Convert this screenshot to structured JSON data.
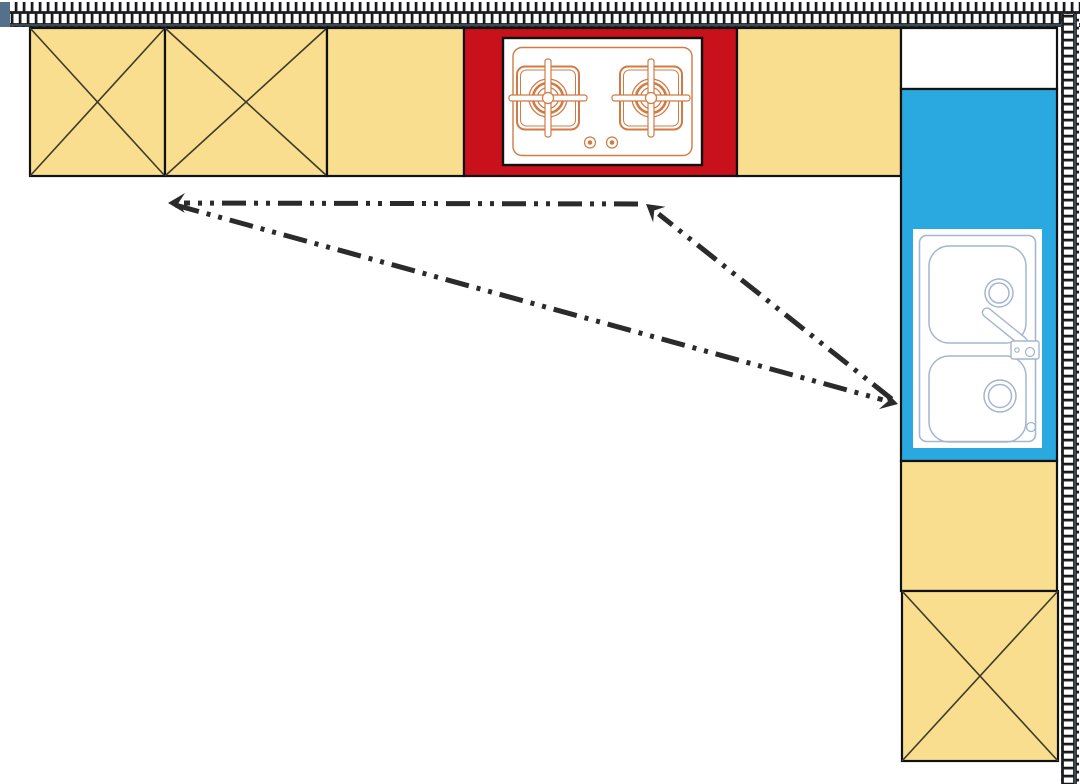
{
  "diagram": {
    "type": "kitchen-floor-plan-with-work-triangle",
    "colors": {
      "cabinet_yellow": "#F8DE8E",
      "stove_red": "#C8111A",
      "sink_blue": "#29A9E0",
      "wall_mortar": "#54718C",
      "brick_fill": "#FFFFFF",
      "brick_outline": "#151515",
      "outline_black": "#111111",
      "cross_line": "#3F3A2A",
      "stove_line_orange": "#D07B45",
      "sink_line_blue": "#A4B6D2",
      "arrow_dark": "#2B2B2B",
      "floor_white": "#FFFFFF"
    },
    "walls": [
      {
        "name": "top-wall",
        "x": 0,
        "y": 2,
        "w": 1080,
        "h": 25,
        "orientation": "horizontal"
      },
      {
        "name": "right-wall",
        "x": 1061,
        "y": 14,
        "w": 18,
        "h": 770,
        "orientation": "vertical"
      }
    ],
    "counter_cells": [
      {
        "name": "base-cabinet-1",
        "x": 30,
        "y": 28,
        "w": 135,
        "h": 148,
        "fill": "yellow",
        "crossed": true
      },
      {
        "name": "base-cabinet-2",
        "x": 165,
        "y": 28,
        "w": 162,
        "h": 148,
        "fill": "yellow",
        "crossed": true
      },
      {
        "name": "base-cabinet-3",
        "x": 327,
        "y": 28,
        "w": 137,
        "h": 148,
        "fill": "yellow",
        "crossed": false
      },
      {
        "name": "cooktop-counter",
        "x": 464,
        "y": 28,
        "w": 273,
        "h": 148,
        "fill": "red",
        "crossed": false
      },
      {
        "name": "base-cabinet-4",
        "x": 737,
        "y": 28,
        "w": 164,
        "h": 148,
        "fill": "yellow",
        "crossed": false
      },
      {
        "name": "corner-counter",
        "x": 901,
        "y": 28,
        "w": 156,
        "h": 61,
        "fill": "white",
        "crossed": false
      },
      {
        "name": "sink-counter",
        "x": 901,
        "y": 89,
        "w": 156,
        "h": 372,
        "fill": "blue",
        "crossed": false
      },
      {
        "name": "base-cabinet-5",
        "x": 901,
        "y": 461,
        "w": 156,
        "h": 130,
        "fill": "yellow",
        "crossed": false
      },
      {
        "name": "base-cabinet-6",
        "x": 902,
        "y": 591,
        "w": 156,
        "h": 170,
        "fill": "yellow",
        "crossed": true
      }
    ],
    "fixtures": {
      "cooktop": {
        "kind": "two-burner-gas-cooktop",
        "x": 503,
        "y": 38,
        "w": 199,
        "h": 127
      },
      "sink": {
        "kind": "double-basin-sink",
        "x": 913,
        "y": 229,
        "w": 129,
        "h": 219
      }
    },
    "work_triangle": {
      "line_style": "dash-dot-dot",
      "vertices": {
        "left_point": [
          168,
          203
        ],
        "cooktop_point": [
          646,
          204
        ],
        "sink_point": [
          898,
          404
        ]
      },
      "segments": [
        {
          "from": "cooktop_point",
          "to": "left_point",
          "arrow_at": "left_point"
        },
        {
          "from": "left_point",
          "to": "sink_point",
          "arrow_at": "sink_point"
        },
        {
          "from": "sink_point",
          "to": "cooktop_point",
          "arrow_at": "cooktop_point"
        }
      ]
    }
  }
}
